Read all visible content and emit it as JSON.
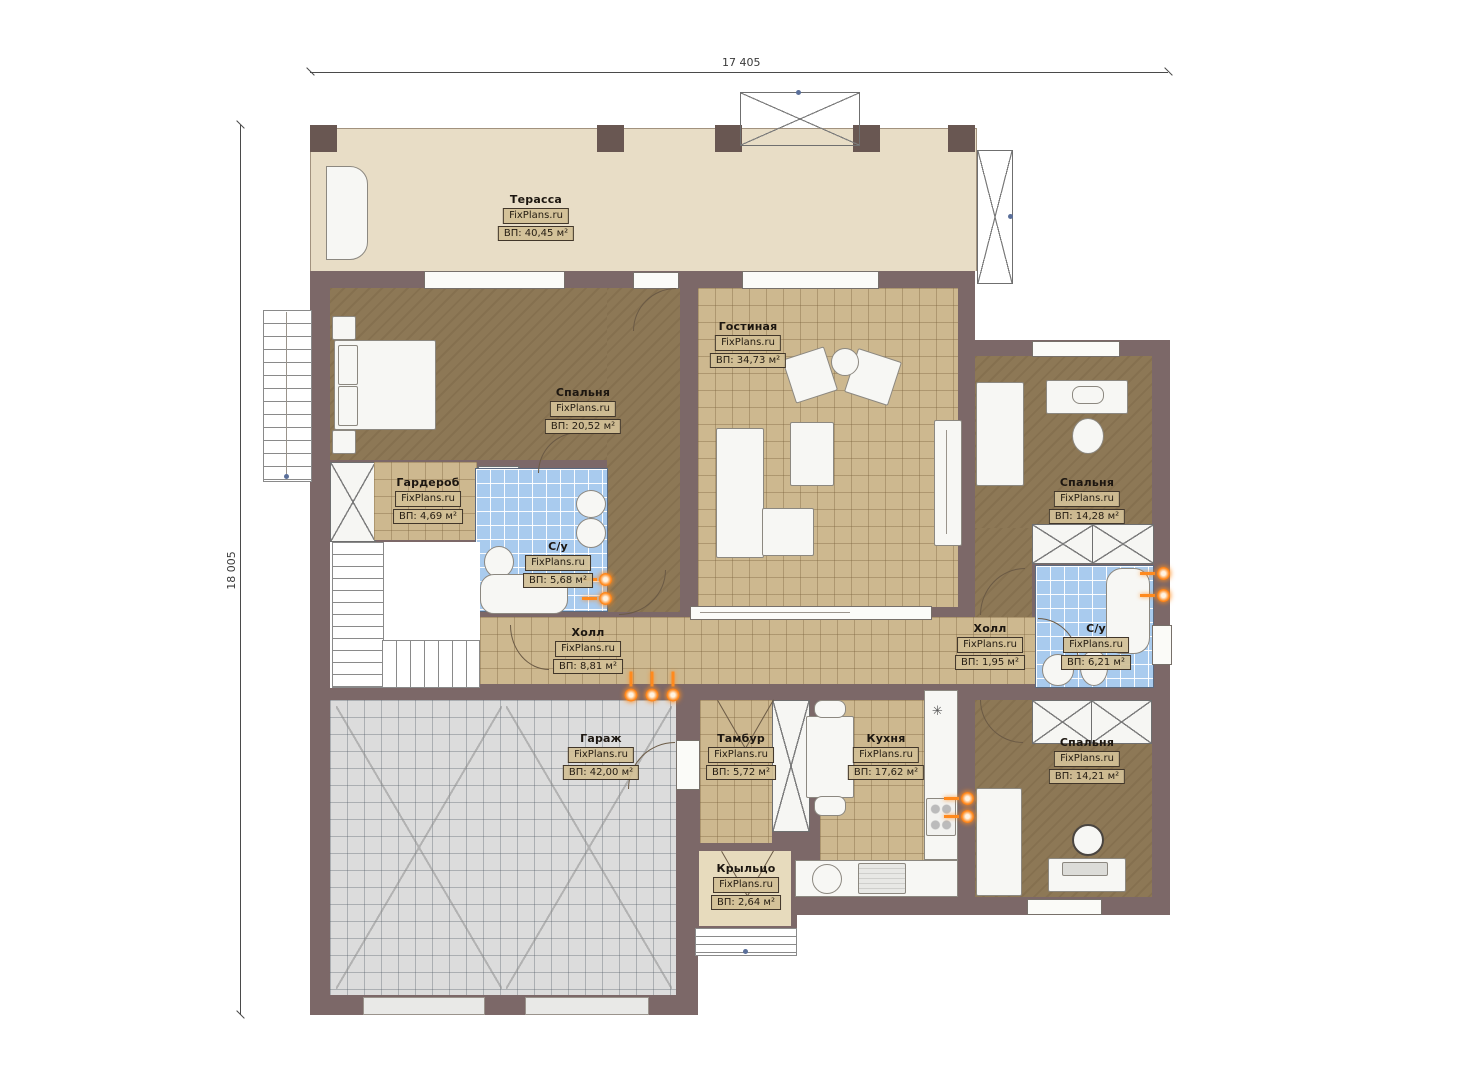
{
  "plan": {
    "title": "floor-plan",
    "watermark": "FixPlans.ru",
    "dimensions": {
      "width_label": "17 405",
      "height_label": "18 005"
    },
    "colors": {
      "wall": "#7c6868",
      "terrace_floor": "#e8ddc6",
      "wood_floor": "#8d7856",
      "tile_floor": "#cdb88f",
      "bath_tile": "#a9cbee",
      "garage_floor": "#dcdcdc",
      "radiator_accent": "#ff8a1e"
    }
  },
  "rooms": [
    {
      "name": "Терасса",
      "site": "FixPlans.ru",
      "area": "ВП: 40,45 м²"
    },
    {
      "name": "Спальня",
      "site": "FixPlans.ru",
      "area": "ВП: 20,52 м²"
    },
    {
      "name": "Гостиная",
      "site": "FixPlans.ru",
      "area": "ВП: 34,73 м²"
    },
    {
      "name": "Гардероб",
      "site": "FixPlans.ru",
      "area": "ВП: 4,69 м²"
    },
    {
      "name": "С/у",
      "site": "FixPlans.ru",
      "area": "ВП: 5,68 м²"
    },
    {
      "name": "Холл",
      "site": "FixPlans.ru",
      "area": "ВП: 8,81 м²"
    },
    {
      "name": "Спальня",
      "site": "FixPlans.ru",
      "area": "ВП: 14,28 м²"
    },
    {
      "name": "Холл",
      "site": "FixPlans.ru",
      "area": "ВП: 1,95 м²"
    },
    {
      "name": "С/у",
      "site": "FixPlans.ru",
      "area": "ВП: 6,21 м²"
    },
    {
      "name": "Гараж",
      "site": "FixPlans.ru",
      "area": "ВП: 42,00 м²"
    },
    {
      "name": "Тамбур",
      "site": "FixPlans.ru",
      "area": "ВП: 5,72 м²"
    },
    {
      "name": "Кухня",
      "site": "FixPlans.ru",
      "area": "ВП: 17,62 м²"
    },
    {
      "name": "Спальня",
      "site": "FixPlans.ru",
      "area": "ВП: 14,21 м²"
    },
    {
      "name": "Крыльцо",
      "site": "FixPlans.ru",
      "area": "ВП: 2,64 м²"
    }
  ],
  "misc": {
    "vent_symbol": "✳"
  }
}
